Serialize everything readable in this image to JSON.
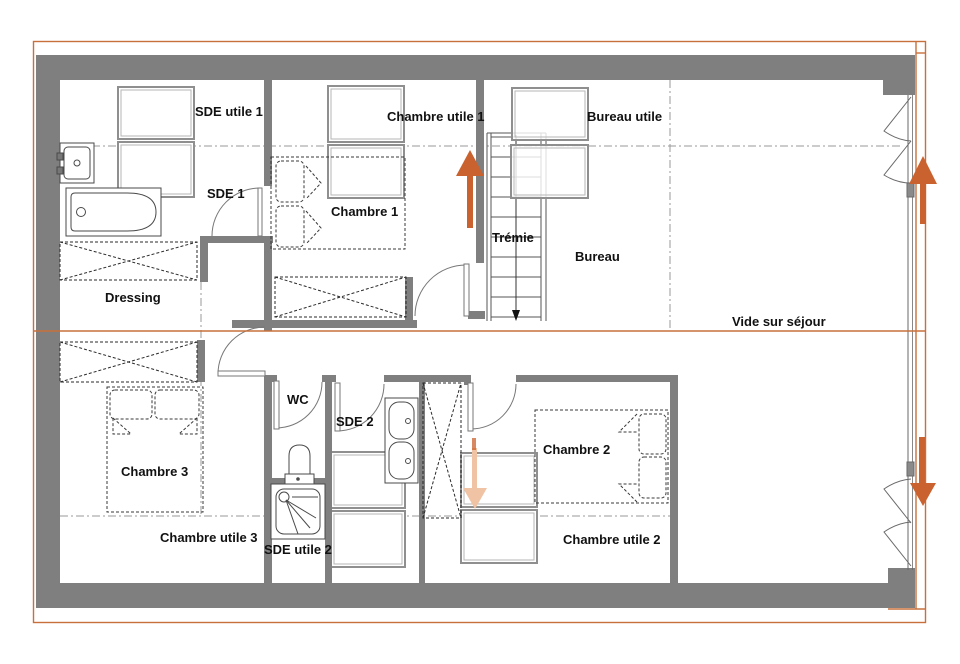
{
  "rooms": {
    "sde_utile_1": "SDE utile 1",
    "chambre_utile_1": "Chambre utile 1",
    "bureau_utile": "Bureau utile",
    "sde_1": "SDE 1",
    "chambre_1": "Chambre 1",
    "tremie": "Trémie",
    "bureau": "Bureau",
    "dressing": "Dressing",
    "vide_sur_sejour": "Vide sur séjour",
    "wc": "WC",
    "sde_2": "SDE 2",
    "chambre_3": "Chambre 3",
    "chambre_2": "Chambre 2",
    "chambre_utile_3": "Chambre utile 3",
    "sde_utile_2": "SDE utile 2",
    "chambre_utile_2": "Chambre utile 2"
  },
  "colors": {
    "wall": "#7f7f7f",
    "accent_orange": "#c8703c",
    "arrow_orange": "#c9622f",
    "arrow_faded": "#f0c3a4",
    "drawing_line": "#4a4a4a",
    "dash_line": "#9a9a9a",
    "text": "#111111"
  },
  "icons": {
    "stair_up_arrow": "up-arrow-icon",
    "stair_flight_arrow": "down-arrow-icon",
    "window_up_arrow": "up-arrow-icon",
    "window_down_arrow": "down-arrow-icon",
    "skylight_faded_arrow": "down-arrow-icon"
  }
}
